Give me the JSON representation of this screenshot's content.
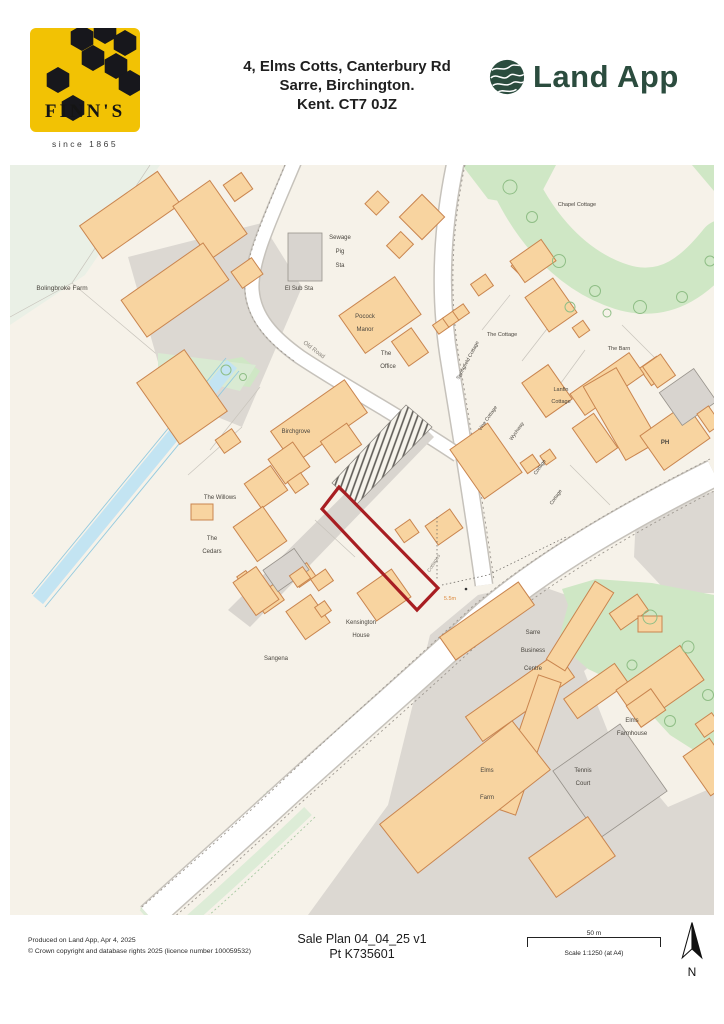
{
  "header": {
    "finns_brand": "FINN'S",
    "finns_since": "since 1865",
    "address_line1": "4, Elms Cotts, Canterbury Rd",
    "address_line2": "Sarre, Birchington.",
    "address_line3": "Kent. CT7 0JZ",
    "landapp_name": "Land App"
  },
  "map": {
    "label_color": "#4a463f",
    "road_label_color": "#8a857d",
    "dimension_label_color": "#dd8a3e",
    "plot_outline_color": "#a81e22",
    "building_fill": "#f8d4a0",
    "building_stroke": "#c9854f",
    "green_fill": "#cfe7c5",
    "water_fill": "#c3e4f2",
    "gray_fill": "#dcd8d2",
    "background": "#f6f2e9",
    "labels": [
      {
        "t": "Bolingbroke Farm",
        "x": 52,
        "y": 125,
        "s": 6.5
      },
      {
        "t": "Sewage",
        "x": 330,
        "y": 74,
        "s": 6
      },
      {
        "t": "Pig",
        "x": 330,
        "y": 88,
        "s": 6
      },
      {
        "t": "Sta",
        "x": 330,
        "y": 102,
        "s": 6
      },
      {
        "t": "El Sub Sta",
        "x": 289,
        "y": 125,
        "s": 6
      },
      {
        "t": "Old Road",
        "x": 303,
        "y": 186,
        "r": 37,
        "s": 6,
        "c": "#8a857d"
      },
      {
        "t": "Chapel Cottage",
        "x": 567,
        "y": 41,
        "s": 5.5
      },
      {
        "t": "Pocock",
        "x": 355,
        "y": 153,
        "s": 6
      },
      {
        "t": "Manor",
        "x": 355,
        "y": 166,
        "s": 6
      },
      {
        "t": "The",
        "x": 376,
        "y": 190,
        "s": 6
      },
      {
        "t": "Office",
        "x": 378,
        "y": 203,
        "s": 6
      },
      {
        "t": "Springfield Cottage",
        "x": 459,
        "y": 196,
        "r": -62,
        "s": 5
      },
      {
        "t": "The Cottage",
        "x": 492,
        "y": 171,
        "s": 5.5
      },
      {
        "t": "The Barn",
        "x": 609,
        "y": 185,
        "s": 5.5
      },
      {
        "t": "Lanfin",
        "x": 551,
        "y": 226,
        "s": 5.5
      },
      {
        "t": "Cottage",
        "x": 551,
        "y": 238,
        "s": 5.5
      },
      {
        "t": "Vine Cottage",
        "x": 479,
        "y": 254,
        "r": -55,
        "s": 5
      },
      {
        "t": "Wychway",
        "x": 508,
        "y": 267,
        "r": -55,
        "s": 5
      },
      {
        "t": "PH",
        "x": 655,
        "y": 279,
        "s": 6,
        "w": "bold"
      },
      {
        "t": "Cottage",
        "x": 531,
        "y": 303,
        "r": -55,
        "s": 5
      },
      {
        "t": "Cottage",
        "x": 547,
        "y": 333,
        "r": -55,
        "s": 5
      },
      {
        "t": "Birchgrove",
        "x": 286,
        "y": 268,
        "s": 6
      },
      {
        "t": "The Willows",
        "x": 210,
        "y": 334,
        "s": 6
      },
      {
        "t": "The",
        "x": 202,
        "y": 375,
        "s": 6
      },
      {
        "t": "Cedars",
        "x": 202,
        "y": 388,
        "s": 6
      },
      {
        "t": "Cottages",
        "x": 425,
        "y": 399,
        "r": -58,
        "s": 5,
        "c": "#8a857d"
      },
      {
        "t": "5.5m",
        "x": 440,
        "y": 435,
        "s": 5.5,
        "c": "#dd8a3e"
      },
      {
        "t": "Kensington",
        "x": 351,
        "y": 459,
        "s": 6
      },
      {
        "t": "House",
        "x": 351,
        "y": 472,
        "s": 6
      },
      {
        "t": "Sangena",
        "x": 266,
        "y": 495,
        "s": 6
      },
      {
        "t": "Sarre",
        "x": 523,
        "y": 469,
        "s": 6
      },
      {
        "t": "Business",
        "x": 523,
        "y": 487,
        "s": 6
      },
      {
        "t": "Centre",
        "x": 523,
        "y": 505,
        "s": 6
      },
      {
        "t": "Elms",
        "x": 622,
        "y": 557,
        "s": 6
      },
      {
        "t": "Farmhouse",
        "x": 622,
        "y": 570,
        "s": 6
      },
      {
        "t": "Elms",
        "x": 477,
        "y": 607,
        "s": 6
      },
      {
        "t": "Farm",
        "x": 477,
        "y": 634,
        "s": 6
      },
      {
        "t": "Tennis",
        "x": 573,
        "y": 607,
        "s": 6
      },
      {
        "t": "Court",
        "x": 573,
        "y": 620,
        "s": 6
      }
    ]
  },
  "footer": {
    "produced_line": "Produced on Land App, Apr 4, 2025",
    "copyright_line": "© Crown copyright and database rights 2025 (licence number 100059532)",
    "plan_title": "Sale Plan 04_04_25 v1",
    "plan_ref": "Pt K735601",
    "scale_distance": "50 m",
    "scale_text": "Scale 1:1250 (at A4)",
    "north_label": "N"
  }
}
